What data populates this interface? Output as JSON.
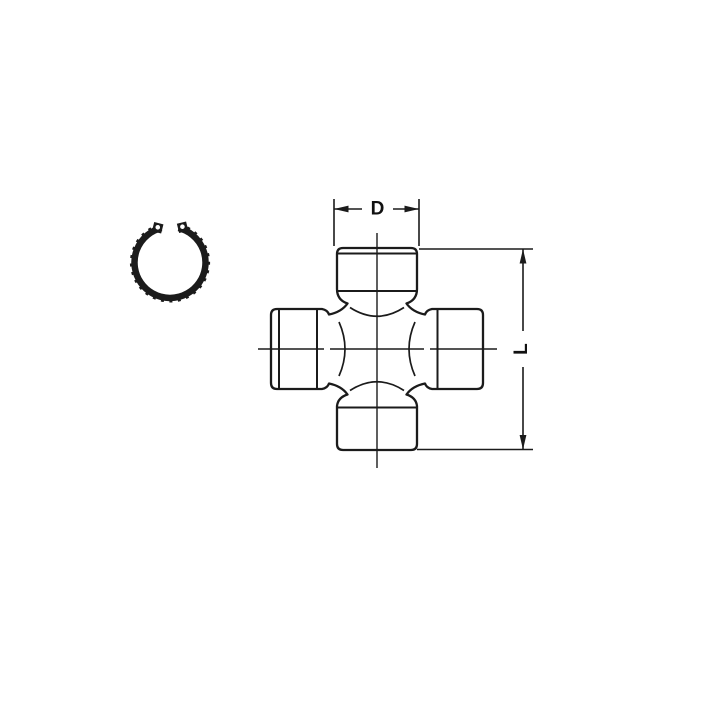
{
  "image": {
    "type": "technical-line-drawing",
    "subject": "universal joint spider cross with bearing cups and snap ring",
    "background_color": "#ffffff",
    "ink_color": "#1b1b1b",
    "parts": [
      {
        "name": "snap-ring"
      },
      {
        "name": "u-joint-cross"
      }
    ],
    "dimensions": {
      "cup_diameter_label": "D",
      "overall_length_label": "L"
    }
  }
}
